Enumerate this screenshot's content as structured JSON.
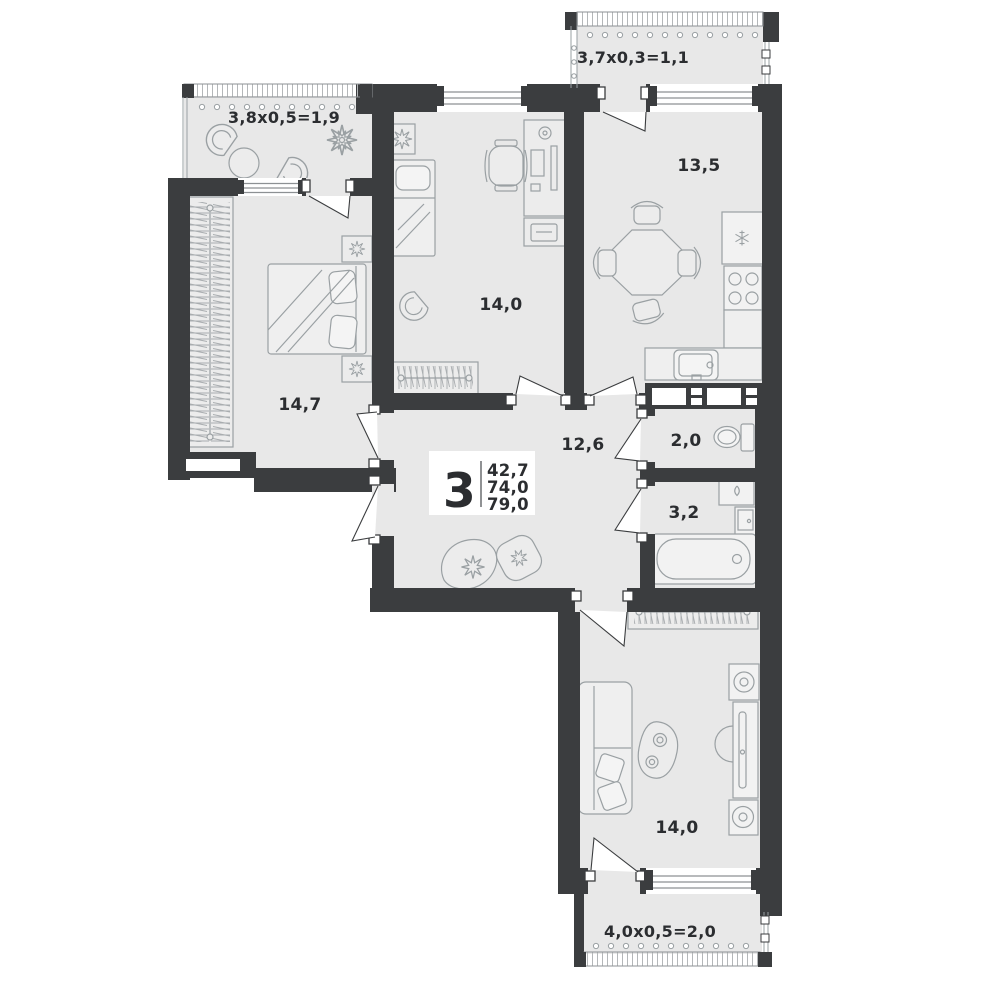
{
  "plan": {
    "legend": {
      "rooms_count": "3",
      "areas": [
        "42,7",
        "74,0",
        "79,0"
      ]
    },
    "rooms": [
      {
        "id": "balcony-top-left",
        "label": "3,8х0,5=1,9"
      },
      {
        "id": "bedroom",
        "label": "14,7"
      },
      {
        "id": "room-middle",
        "label": "14,0"
      },
      {
        "id": "balcony-top-right",
        "label": "3,7х0,3=1,1"
      },
      {
        "id": "kitchen",
        "label": "13,5"
      },
      {
        "id": "hallway",
        "label": "12,6"
      },
      {
        "id": "wc",
        "label": "2,0"
      },
      {
        "id": "bathroom",
        "label": "3,2"
      },
      {
        "id": "living-room",
        "label": "14,0"
      },
      {
        "id": "balcony-bottom",
        "label": "4,0х0,5=2,0"
      }
    ],
    "colors": {
      "wall": "#3b3d3f",
      "floor": "#e8e8e8",
      "furniture_line": "#9aa0a3",
      "background": "#ffffff",
      "text": "#2b2d30"
    }
  }
}
